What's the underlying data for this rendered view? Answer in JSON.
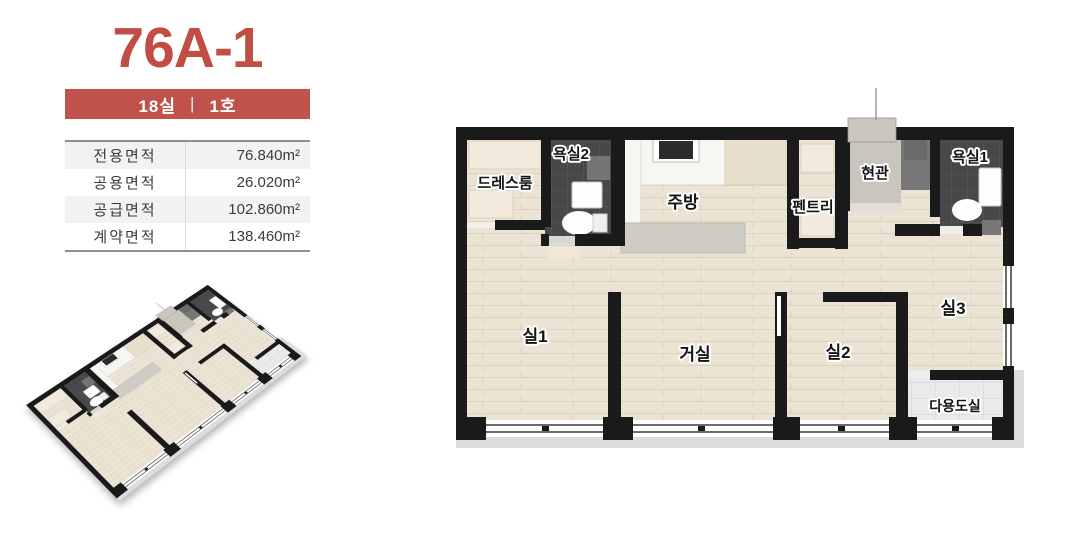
{
  "unit": {
    "title": "76A-1",
    "badge_rooms": "18실",
    "badge_sep": "|",
    "badge_no": "1호"
  },
  "area_table": {
    "rows": [
      {
        "label": "전용면적",
        "value": "76.840m²"
      },
      {
        "label": "공용면적",
        "value": "26.020m²"
      },
      {
        "label": "공급면적",
        "value": "102.860m²"
      },
      {
        "label": "계약면적",
        "value": "138.460m²"
      }
    ]
  },
  "floor_plan": {
    "rooms": [
      {
        "id": "dress-room",
        "label": "드레스룸"
      },
      {
        "id": "bathroom-2",
        "label": "욕실2"
      },
      {
        "id": "kitchen",
        "label": "주방"
      },
      {
        "id": "pantry",
        "label": "펜트리"
      },
      {
        "id": "entrance",
        "label": "현관"
      },
      {
        "id": "bathroom-1",
        "label": "욕실1"
      },
      {
        "id": "room-1",
        "label": "실1"
      },
      {
        "id": "living-room",
        "label": "거실"
      },
      {
        "id": "room-2",
        "label": "실2"
      },
      {
        "id": "room-3",
        "label": "실3"
      },
      {
        "id": "utility-room",
        "label": "다용도실"
      }
    ]
  },
  "colors": {
    "accent_red": "#C1524B",
    "title_red": "#C14E45",
    "wall_black": "#1A1A1A",
    "wood_floor": "#EBE3D4",
    "dark_tile": "#484848",
    "light_tile": "#EAEAEA",
    "concrete": "#CAC6BE"
  }
}
